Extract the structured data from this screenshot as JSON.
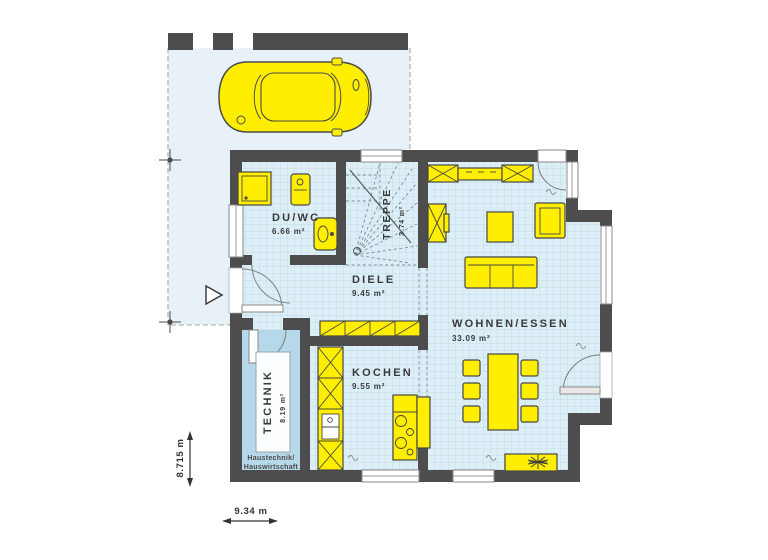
{
  "rooms": {
    "duwc": {
      "name": "DU/WC",
      "area": "6.66 m²"
    },
    "treppe": {
      "name": "TREPPE",
      "area": "3.74 m²"
    },
    "diele": {
      "name": "DIELE",
      "area": "9.45 m²"
    },
    "wohnen_essen": {
      "name": "WOHNEN/ESSEN",
      "area": "33.09 m²"
    },
    "kochen": {
      "name": "KOCHEN",
      "area": "9.55 m²"
    },
    "technik": {
      "name": "TECHNIK",
      "area": "8.19 m²",
      "note_line1": "Haustechnik/",
      "note_line2": "Hauswirtschaft"
    }
  },
  "dimensions": {
    "overall_width": "9.34 m",
    "overall_height": "8.715 m"
  },
  "colors": {
    "wall": "#4d4d4d",
    "floor": "#dceef6",
    "floor_grid": "#c3dce8",
    "technik_floor": "#b4d8ea",
    "carport_floor": "#e8f1f7",
    "furniture_yellow": "#ffee00",
    "outline": "#474747"
  },
  "icons": {
    "car": "car-top-view-icon",
    "plant": "potted-plant-icon",
    "shower": "shower-icon",
    "washbasin": "washbasin-icon",
    "toilet": "toilet-icon",
    "kitchen_sink": "kitchen-sink-icon",
    "cooktop": "cooktop-icon",
    "entrance_marker": "entrance-arrow-icon",
    "survey_marker": "survey-cross-icon"
  }
}
